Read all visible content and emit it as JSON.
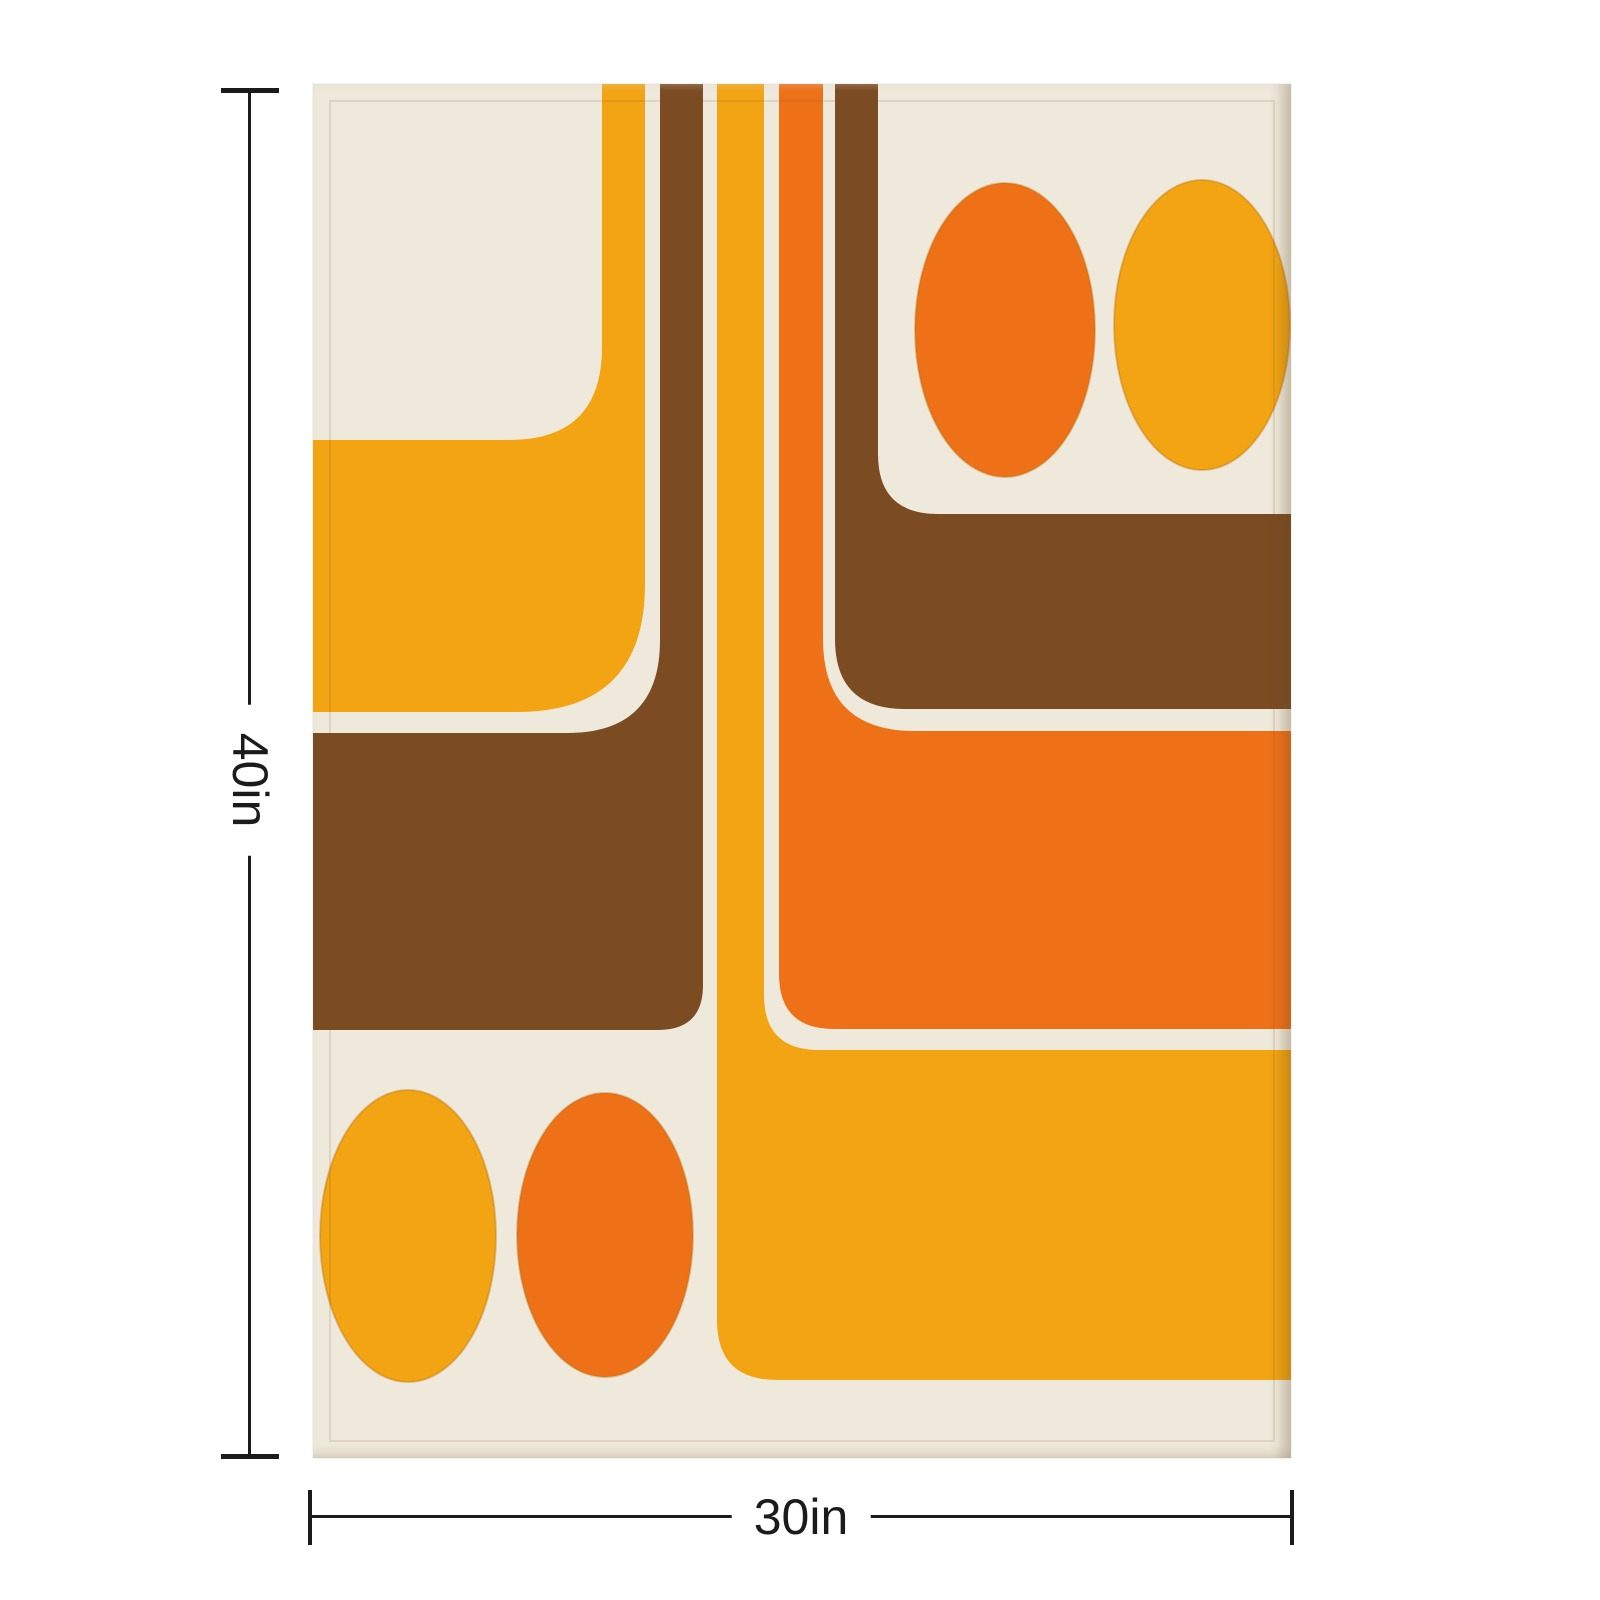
{
  "page": {
    "kind": "product-dimension-mockup",
    "subject": "retro 70s geometric throw blanket"
  },
  "dimensions": {
    "height_label": "40in",
    "width_label": "30in"
  },
  "colors": {
    "page-bg": "#ffffff",
    "cream": "#efe9db",
    "yellow": "#f2a413",
    "orange": "#ee7118",
    "brown": "#7b4b22",
    "line": "#1b1b1b",
    "hem": "rgba(110,85,45,0.14)"
  },
  "artwork": {
    "style": "retro 1970s geometric stripes, bands and ovals on cream",
    "shapes": [
      "yellow L-band upper-left",
      "brown L-band middle-left",
      "yellow stripe merging into bottom-right block",
      "orange stripe merging into right block",
      "brown stripe merging into upper-right band",
      "orange oval top-right",
      "yellow oval top-right",
      "yellow oval bottom-left",
      "orange oval bottom-left"
    ]
  }
}
